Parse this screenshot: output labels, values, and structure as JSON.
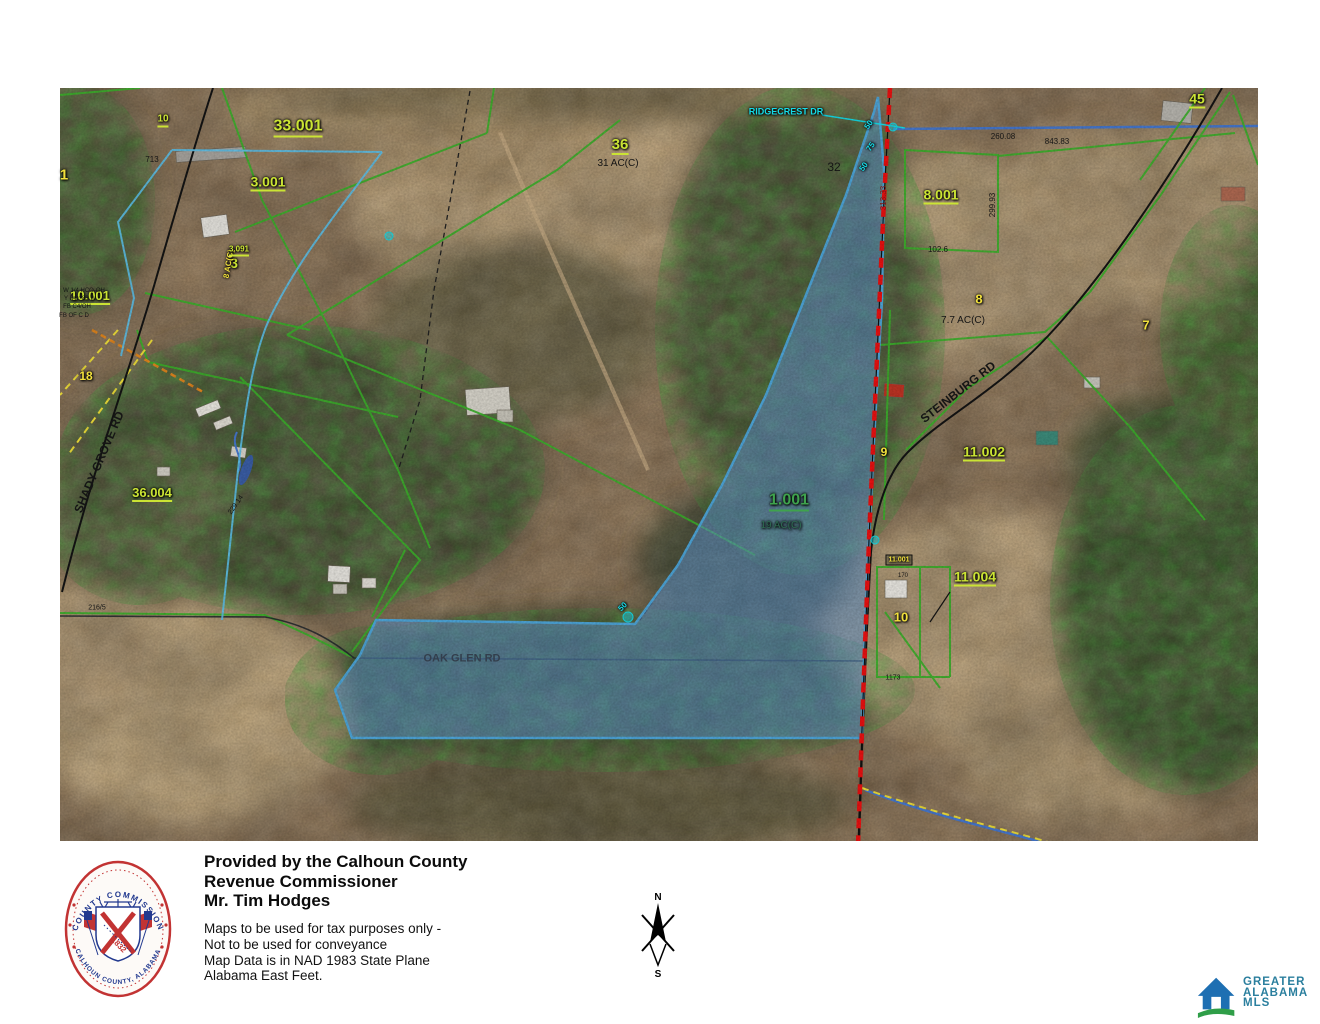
{
  "colors": {
    "chartreuse": "#cbe434",
    "yellow": "#f2e13c",
    "green": "#3fa34d",
    "darkteal": "#2e6b52",
    "cyan": "#16dce8",
    "black": "#151515",
    "darkred": "#7e1414",
    "roadgray": "#333e4c",
    "parcel_fill": "rgba(96,152,212,0.55)",
    "parcel_stroke": "#4fa8dc",
    "boundary_red": "#ee1111",
    "parcel_line_green": "#3db32c",
    "stream_blue": "#4779d0",
    "mls_blue": "#1e6fb2",
    "mls_green": "#2f9e48",
    "mls_text": "#2b7f9e",
    "seal_red": "#c23333",
    "seal_navy": "#22398f"
  },
  "map": {
    "labels": [
      {
        "t": "33.001",
        "x": 298,
        "y": 128,
        "s": 16,
        "c": "chartreuse",
        "u": true,
        "b": true
      },
      {
        "t": "3.001",
        "x": 268,
        "y": 183,
        "s": 14,
        "c": "chartreuse",
        "u": true,
        "b": true
      },
      {
        "t": "3",
        "x": 234,
        "y": 263,
        "s": 14,
        "c": "chartreuse",
        "b": true
      },
      {
        "t": "10",
        "x": 163,
        "y": 121,
        "s": 10,
        "c": "chartreuse",
        "u": true,
        "b": true
      },
      {
        "t": "10.001",
        "x": 90,
        "y": 297,
        "s": 13,
        "c": "chartreuse",
        "u": true,
        "b": true
      },
      {
        "t": "1",
        "x": 64,
        "y": 175,
        "s": 15,
        "c": "yellow",
        "b": true
      },
      {
        "t": "18",
        "x": 86,
        "y": 376,
        "s": 12,
        "c": "yellow",
        "b": true
      },
      {
        "t": "8 AC(C)",
        "x": 229,
        "y": 264,
        "s": 8,
        "c": "yellow",
        "r": -80,
        "b": true
      },
      {
        "t": "3.091",
        "x": 239,
        "y": 251,
        "s": 8,
        "c": "chartreuse",
        "u": true,
        "b": true
      },
      {
        "t": "713",
        "x": 152,
        "y": 160,
        "s": 8,
        "c": "black"
      },
      {
        "t": "36.004",
        "x": 152,
        "y": 494,
        "s": 13,
        "c": "chartreuse",
        "u": true,
        "b": true
      },
      {
        "t": "36",
        "x": 620,
        "y": 146,
        "s": 15,
        "c": "chartreuse",
        "u": true,
        "b": true
      },
      {
        "t": "31 AC(C)",
        "x": 618,
        "y": 164,
        "s": 10,
        "c": "black"
      },
      {
        "t": "32",
        "x": 834,
        "y": 167,
        "s": 12,
        "c": "black"
      },
      {
        "t": "RIDGECREST DR",
        "x": 786,
        "y": 112,
        "s": 9,
        "c": "cyan",
        "b": true
      },
      {
        "t": "45",
        "x": 1197,
        "y": 100,
        "s": 14,
        "c": "chartreuse",
        "u": true,
        "b": true
      },
      {
        "t": "260.08",
        "x": 1003,
        "y": 137,
        "s": 8,
        "c": "black"
      },
      {
        "t": "843.83",
        "x": 1057,
        "y": 142,
        "s": 8,
        "c": "black"
      },
      {
        "t": "8.001",
        "x": 941,
        "y": 196,
        "s": 14,
        "c": "chartreuse",
        "u": true,
        "b": true
      },
      {
        "t": "299.93",
        "x": 993,
        "y": 205,
        "s": 8,
        "c": "black",
        "r": -90
      },
      {
        "t": "102.6",
        "x": 938,
        "y": 250,
        "s": 8,
        "c": "black"
      },
      {
        "t": "8",
        "x": 979,
        "y": 299,
        "s": 13,
        "c": "yellow",
        "b": true
      },
      {
        "t": "7.7 AC(C)",
        "x": 963,
        "y": 321,
        "s": 10,
        "c": "black"
      },
      {
        "t": "7",
        "x": 1146,
        "y": 325,
        "s": 13,
        "c": "yellow",
        "b": true
      },
      {
        "t": "STEINBURG RD",
        "x": 958,
        "y": 392,
        "s": 12,
        "c": "black",
        "r": -38,
        "b": true
      },
      {
        "t": "11.002",
        "x": 984,
        "y": 453,
        "s": 14,
        "c": "chartreuse",
        "u": true,
        "b": true
      },
      {
        "t": "9",
        "x": 884,
        "y": 452,
        "s": 12,
        "c": "yellow",
        "b": true
      },
      {
        "t": "1.001",
        "x": 789,
        "y": 502,
        "s": 16,
        "c": "green",
        "u": true,
        "b": true
      },
      {
        "t": "19 AC(C)",
        "x": 781,
        "y": 526,
        "s": 10,
        "c": "darkteal"
      },
      {
        "t": "SHADY GROVE RD",
        "x": 99,
        "y": 462,
        "s": 12,
        "c": "black",
        "r": -67,
        "b": true
      },
      {
        "t": "11.001",
        "x": 899,
        "y": 560,
        "s": 7,
        "c": "yellow",
        "box": true,
        "b": true
      },
      {
        "t": "170",
        "x": 903,
        "y": 576,
        "s": 6,
        "c": "black"
      },
      {
        "t": "10",
        "x": 901,
        "y": 617,
        "s": 13,
        "c": "yellow",
        "b": true
      },
      {
        "t": "1173",
        "x": 893,
        "y": 678,
        "s": 7,
        "c": "black"
      },
      {
        "t": "11.004",
        "x": 975,
        "y": 578,
        "s": 14,
        "c": "chartreuse",
        "u": true,
        "b": true
      },
      {
        "t": "OAK GLEN RD",
        "x": 462,
        "y": 659,
        "s": 11,
        "c": "roadgray",
        "b": true
      },
      {
        "t": "313.33",
        "x": 884,
        "y": 198,
        "s": 8,
        "c": "darkred",
        "r": -90
      },
      {
        "t": "50",
        "x": 869,
        "y": 125,
        "s": 8,
        "c": "cyan",
        "r": -55,
        "b": true
      },
      {
        "t": "75",
        "x": 871,
        "y": 147,
        "s": 8,
        "c": "cyan",
        "r": -55,
        "b": true
      },
      {
        "t": "50",
        "x": 864,
        "y": 167,
        "s": 8,
        "c": "cyan",
        "r": -55,
        "b": true
      },
      {
        "t": "50",
        "x": 623,
        "y": 607,
        "s": 8,
        "c": "cyan",
        "r": -45,
        "b": true
      },
      {
        "t": "216/5",
        "x": 97,
        "y": 608,
        "s": 7,
        "c": "black"
      },
      {
        "t": "229.14",
        "x": 236,
        "y": 505,
        "s": 7,
        "c": "black",
        "r": -55
      },
      {
        "t": "W 1/4 HCO-OH",
        "x": 84,
        "y": 291,
        "s": 6,
        "c": "black"
      },
      {
        "t": "Y DO: 83 W",
        "x": 80,
        "y": 299,
        "s": 6,
        "c": "black"
      },
      {
        "t": "FB C4/OH",
        "x": 77,
        "y": 307,
        "s": 6,
        "c": "black"
      },
      {
        "t": "FB OF C D",
        "x": 74,
        "y": 316,
        "s": 6,
        "c": "black"
      }
    ]
  },
  "footer": {
    "provided": [
      "Provided by the Calhoun County",
      "Revenue Commissioner",
      "Mr. Tim Hodges"
    ],
    "disclaimer": [
      "Maps to be used for tax purposes only -",
      "Not to be used for conveyance",
      "Map Data is in NAD 1983 State Plane",
      "Alabama East Feet."
    ]
  },
  "seal": {
    "ring_top": "COUNTY COMMISSION",
    "ring_bottom": "CALHOUN COUNTY, ALABAMA",
    "year": "1832"
  },
  "compass": {
    "north": "N",
    "south": "S"
  },
  "mls": {
    "lines": [
      "GREATER",
      "ALABAMA",
      "MLS"
    ]
  }
}
